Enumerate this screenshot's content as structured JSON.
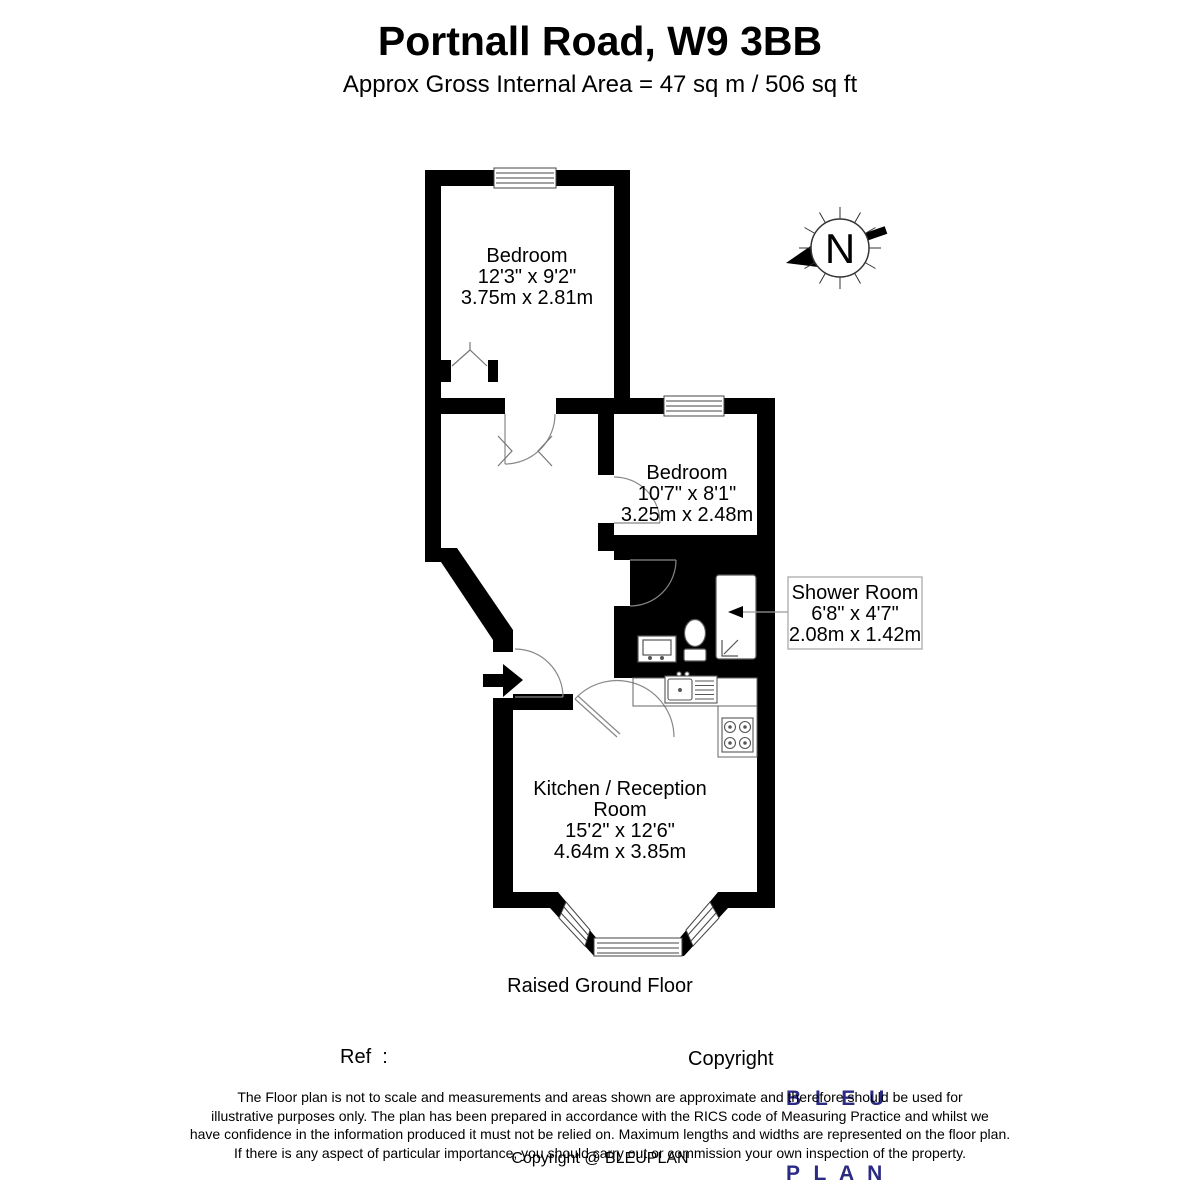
{
  "title": "Portnall Road, W9 3BB",
  "subtitle": "Approx Gross Internal Area = 47 sq m / 506 sq ft",
  "floor_label": "Raised Ground Floor",
  "compass": {
    "north_label": "N"
  },
  "rooms": [
    {
      "name": "Bedroom",
      "imperial": "12'3\" x 9'2\"",
      "metric": "3.75m x 2.81m"
    },
    {
      "name": "Bedroom",
      "imperial": "10'7\" x 8'1\"",
      "metric": "3.25m x 2.48m"
    },
    {
      "name": "Shower Room",
      "imperial": "6'8\" x 4'7\"",
      "metric": "2.08m x 1.42m"
    },
    {
      "name_line1": "Kitchen / Reception",
      "name_line2": "Room",
      "imperial": "15'2\" x 12'6\"",
      "metric": "4.64m x 3.85m"
    }
  ],
  "footer": {
    "ref_label": "Ref  :",
    "copyright_label": "Copyright",
    "logo_line1": "B L E U",
    "logo_line2": "P L A N",
    "logo_color": "#2b2b84",
    "disclaimer_lines": [
      "The Floor plan is not to scale and measurements and areas shown are approximate and therefore should be used for",
      "illustrative purposes only. The plan has been prepared in accordance with the RICS code of Measuring Practice and whilst we",
      "have confidence in the information produced it must not be relied on. Maximum lengths and widths are represented on the floor plan.",
      "If there is any aspect of particular importance, you should carry out or commission your own inspection of the property."
    ],
    "copyright_bottom": "Copyright @ BLEUPLAN"
  }
}
